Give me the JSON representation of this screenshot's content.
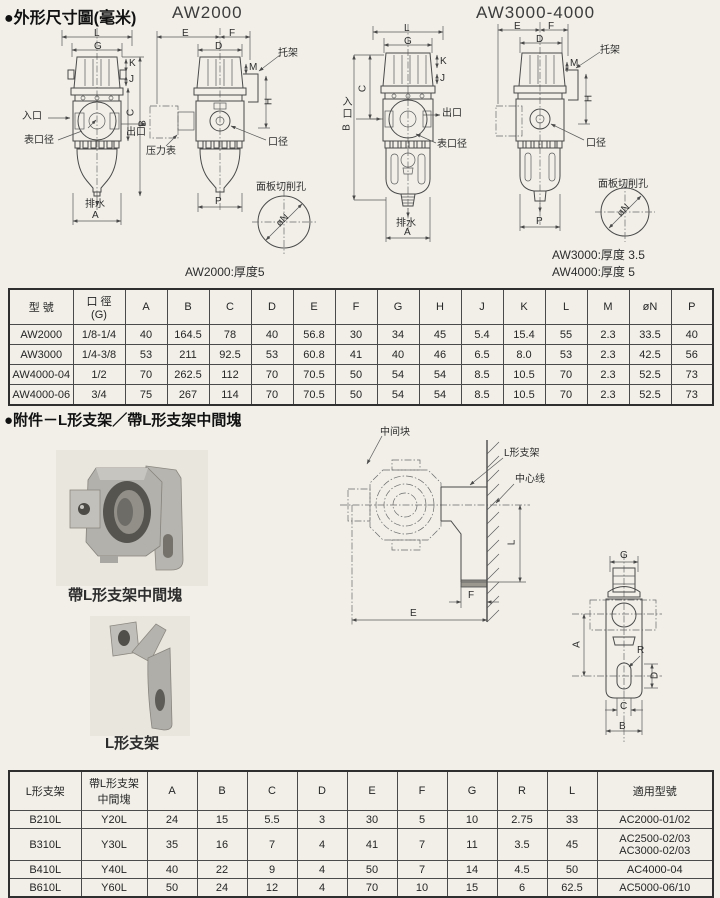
{
  "page": {
    "title_dimensions": "●外形尺寸圖(毫米)",
    "model_aw2000": "AW2000",
    "model_aw3000_4000": "AW3000-4000",
    "note_aw2000": "AW2000:厚度5",
    "note_aw3000": "AW3000:厚度 3.5",
    "note_aw4000": "AW4000:厚度 5",
    "title_accessories": "●附件－L形支架／帶L形支架中間塊",
    "photo_block_label": "帶L形支架中間塊",
    "photo_bracket_label": "L形支架"
  },
  "labels": {
    "inlet": "入口",
    "outlet": "出口",
    "gauge_port": "表口径",
    "pressure_gauge": "压力表",
    "port": "口径",
    "drain": "排水",
    "bracket": "托架",
    "panel_hole": "面板切削孔",
    "middle_block": "中间块",
    "l_bracket": "L形支架",
    "center_line": "中心线",
    "phi_n": "øN"
  },
  "dims": {
    "A": "A",
    "B": "B",
    "C": "C",
    "D": "D",
    "E": "E",
    "F": "F",
    "G": "G",
    "H": "H",
    "J": "J",
    "K": "K",
    "L": "L",
    "M": "M",
    "P": "P",
    "R": "R"
  },
  "table1": {
    "col_model": "型 號",
    "col_bore_line1": "口 徑",
    "col_bore_line2": "(G)",
    "dim_headers": [
      "A",
      "B",
      "C",
      "D",
      "E",
      "F",
      "G",
      "H",
      "J",
      "K",
      "L",
      "M",
      "øN",
      "P"
    ],
    "rows": [
      {
        "model": "AW2000",
        "bore": "1/8-1/4",
        "values": [
          "40",
          "164.5",
          "78",
          "40",
          "56.8",
          "30",
          "34",
          "45",
          "5.4",
          "15.4",
          "55",
          "2.3",
          "33.5",
          "40"
        ]
      },
      {
        "model": "AW3000",
        "bore": "1/4-3/8",
        "values": [
          "53",
          "211",
          "92.5",
          "53",
          "60.8",
          "41",
          "40",
          "46",
          "6.5",
          "8.0",
          "53",
          "2.3",
          "42.5",
          "56"
        ]
      },
      {
        "model": "AW4000-04",
        "bore": "1/2",
        "values": [
          "70",
          "262.5",
          "112",
          "70",
          "70.5",
          "50",
          "54",
          "54",
          "8.5",
          "10.5",
          "70",
          "2.3",
          "52.5",
          "73"
        ]
      },
      {
        "model": "AW4000-06",
        "bore": "3/4",
        "values": [
          "75",
          "267",
          "114",
          "70",
          "70.5",
          "50",
          "54",
          "54",
          "8.5",
          "10.5",
          "70",
          "2.3",
          "52.5",
          "73"
        ]
      }
    ]
  },
  "table2": {
    "col_bracket": "L形支架",
    "col_block_line1": "帶L形支架",
    "col_block_line2": "中間塊",
    "dim_headers": [
      "A",
      "B",
      "C",
      "D",
      "E",
      "F",
      "G",
      "R",
      "L"
    ],
    "col_applicable": "適用型號",
    "rows": [
      {
        "bracket": "B210L",
        "block": "Y20L",
        "values": [
          "24",
          "15",
          "5.5",
          "3",
          "30",
          "5",
          "10",
          "2.75",
          "33"
        ],
        "applicable": [
          "AC2000-01/02"
        ]
      },
      {
        "bracket": "B310L",
        "block": "Y30L",
        "values": [
          "35",
          "16",
          "7",
          "4",
          "41",
          "7",
          "11",
          "3.5",
          "45"
        ],
        "applicable": [
          "AC2500-02/03",
          "AC3000-02/03"
        ]
      },
      {
        "bracket": "B410L",
        "block": "Y40L",
        "values": [
          "40",
          "22",
          "9",
          "4",
          "50",
          "7",
          "14",
          "4.5",
          "50"
        ],
        "applicable": [
          "AC4000-04"
        ]
      },
      {
        "bracket": "B610L",
        "block": "Y60L",
        "values": [
          "50",
          "24",
          "12",
          "4",
          "70",
          "10",
          "15",
          "6",
          "62.5"
        ],
        "applicable": [
          "AC5000-06/10"
        ]
      }
    ]
  }
}
